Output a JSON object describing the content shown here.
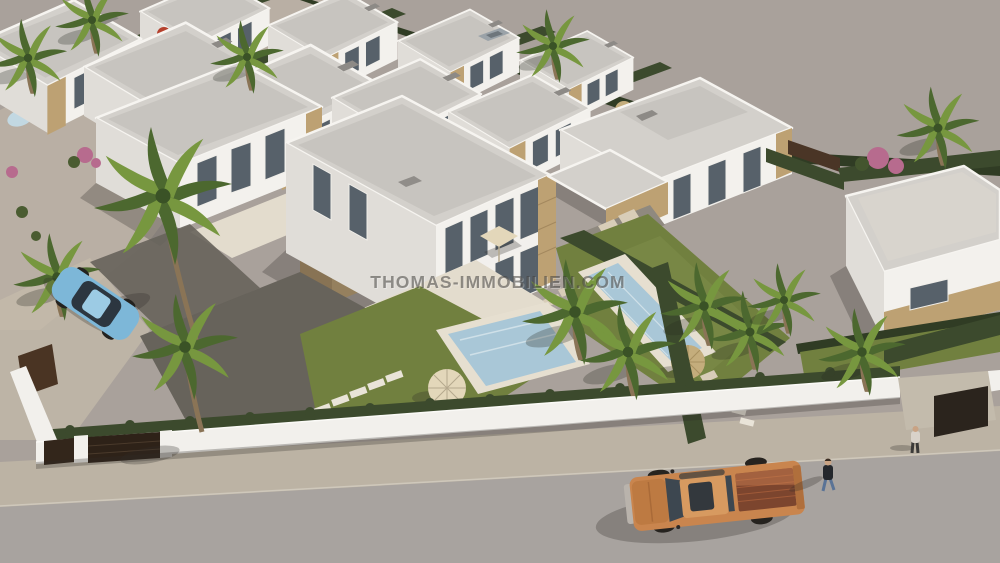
{
  "meta": {
    "type": "3d-architectural-rendering",
    "subject": "Aerial view of a modern white villa development with pools, palm trees, perimeter walls, a street with a copper pickup truck, a blue car and two pedestrians"
  },
  "watermark": {
    "text": "THOMAS-IMMOBILIEN.COM"
  },
  "colors": {
    "ground": "#a9a19b",
    "sand": "#c6bcab",
    "gravel": "#67635b",
    "street": "#a8a39f",
    "sidewalk": "#bcb3a4",
    "curb": "#d6cfc2",
    "wall_white": "#f2f0ec",
    "wall_shade": "#e0ddd8",
    "roof_gray": "#c7c4bf",
    "roof_light": "#d3d0cb",
    "parapet": "#f6f4f0",
    "stone": "#bda173",
    "stone_dark": "#ab8f66",
    "window_glass": "#57616a",
    "hedge": "#3c4a2d",
    "hedge_dark": "#303c24",
    "lawn": "#71803f",
    "palm_dark": "#4c682f",
    "palm_light": "#77973f",
    "palm_trunk": "#8a7456",
    "pool": "#a9c7d7",
    "pool_light": "#c2d8e2",
    "deck": "#e6dfd0",
    "parasol_cream": "#e3d7ba",
    "parasol_straw": "#c4ad7c",
    "parasol_red": "#b5402c",
    "bougainvillea": "#b76b8e",
    "gate_brown": "#33261b",
    "truck_body": "#c9854e",
    "truck_hood": "#bd7a42",
    "truck_bed": "#7c452e",
    "truck_glass": "#3d4750",
    "car_blue": "#7db7d8",
    "skin": "#c9a384",
    "jacket": "#24272c",
    "jeans": "#5a7396",
    "shirt": "#d9d2c9",
    "shadow": "rgba(45,42,38,0.30)",
    "watermark_fill": "rgba(66,63,60,0.55)",
    "watermark_highlight": "rgba(255,255,255,0.28)"
  }
}
